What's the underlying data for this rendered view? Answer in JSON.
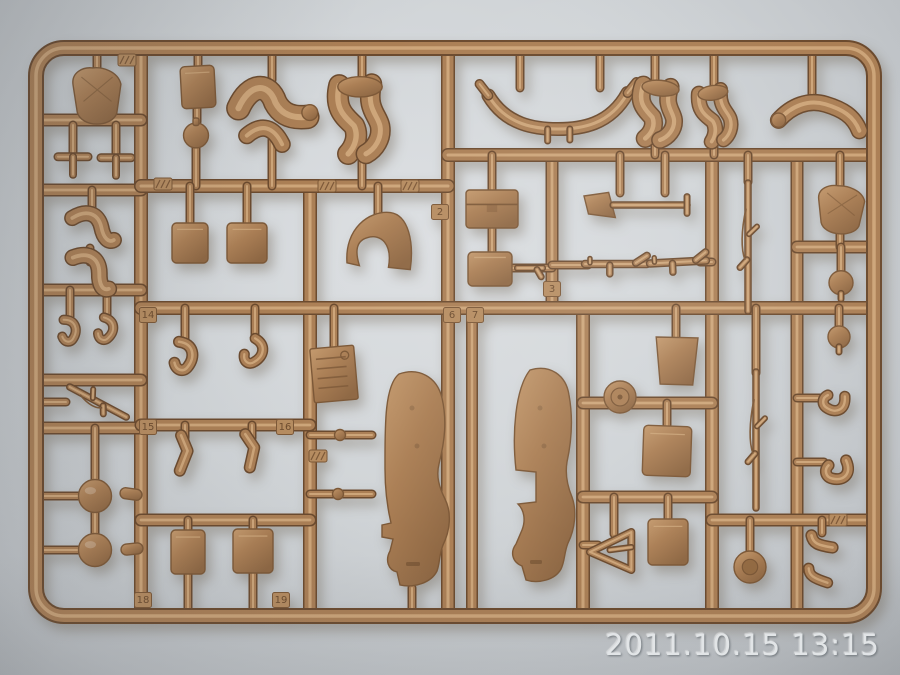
{
  "photo": {
    "timestamp": "2011.10.15 13:15"
  },
  "colors": {
    "background_center": "#dcdfe2",
    "background_mid": "#d0d4d7",
    "background_edge": "#bfc3c7",
    "background_corner": "#aeb2b6",
    "plastic": "#ab7f55",
    "plastic_light": "#c49a6e",
    "plastic_highlight": "#d2ac80",
    "plastic_dark": "#7c5837",
    "plastic_deep": "#6b4a2e",
    "tag_fill": "#b68c60",
    "engraving": "#6d4c2e",
    "timestamp_text": "#e5e8ea",
    "timestamp_shadow": "#747a7f"
  },
  "sprue": {
    "frame": {
      "x": 36,
      "y": 48,
      "w": 838,
      "h": 568,
      "rx": 28,
      "thickness": 12
    },
    "runners": [
      [
        141,
        48,
        141,
        616,
        11
      ],
      [
        310,
        186,
        310,
        616,
        11
      ],
      [
        448,
        48,
        448,
        616,
        11
      ],
      [
        472,
        308,
        472,
        616,
        9
      ],
      [
        552,
        155,
        552,
        308,
        10
      ],
      [
        583,
        308,
        583,
        616,
        11
      ],
      [
        712,
        155,
        712,
        616,
        11
      ],
      [
        797,
        155,
        797,
        616,
        10
      ],
      [
        36,
        120,
        141,
        120,
        10
      ],
      [
        36,
        190,
        141,
        190,
        10
      ],
      [
        36,
        290,
        141,
        290,
        10
      ],
      [
        36,
        380,
        141,
        380,
        10
      ],
      [
        36,
        428,
        141,
        428,
        10
      ],
      [
        141,
        186,
        448,
        186,
        11
      ],
      [
        448,
        155,
        874,
        155,
        11
      ],
      [
        141,
        308,
        874,
        308,
        11
      ],
      [
        141,
        425,
        310,
        425,
        10
      ],
      [
        141,
        520,
        310,
        520,
        10
      ],
      [
        583,
        403,
        712,
        403,
        10
      ],
      [
        583,
        497,
        712,
        497,
        10
      ],
      [
        797,
        247,
        874,
        247,
        10
      ],
      [
        712,
        520,
        874,
        520,
        10
      ]
    ],
    "stubs": [
      [
        97,
        48,
        97,
        72
      ],
      [
        198,
        48,
        198,
        68
      ],
      [
        272,
        48,
        272,
        80
      ],
      [
        362,
        48,
        362,
        82
      ],
      [
        520,
        48,
        520,
        88
      ],
      [
        600,
        48,
        600,
        88
      ],
      [
        655,
        48,
        655,
        84
      ],
      [
        714,
        48,
        714,
        86
      ],
      [
        812,
        48,
        812,
        95
      ],
      [
        272,
        140,
        272,
        186
      ],
      [
        362,
        150,
        362,
        186
      ],
      [
        655,
        136,
        655,
        155
      ],
      [
        714,
        140,
        714,
        155
      ],
      [
        73,
        125,
        73,
        158
      ],
      [
        116,
        125,
        116,
        158
      ],
      [
        92,
        190,
        92,
        210
      ],
      [
        90,
        248,
        90,
        262
      ],
      [
        70,
        290,
        70,
        318
      ],
      [
        107,
        290,
        107,
        318
      ],
      [
        36,
        402,
        66,
        402
      ],
      [
        36,
        496,
        80,
        496
      ],
      [
        36,
        550,
        80,
        550
      ],
      [
        95,
        428,
        95,
        481
      ],
      [
        95,
        512,
        95,
        535
      ],
      [
        197,
        108,
        197,
        122
      ],
      [
        196,
        144,
        196,
        186
      ],
      [
        190,
        186,
        190,
        224
      ],
      [
        247,
        186,
        247,
        224
      ],
      [
        185,
        308,
        185,
        340
      ],
      [
        255,
        308,
        255,
        338
      ],
      [
        185,
        425,
        185,
        438
      ],
      [
        252,
        425,
        252,
        438
      ],
      [
        188,
        520,
        188,
        532
      ],
      [
        253,
        520,
        253,
        531
      ],
      [
        188,
        572,
        188,
        616
      ],
      [
        253,
        572,
        253,
        616
      ],
      [
        378,
        186,
        378,
        216
      ],
      [
        334,
        308,
        334,
        350
      ],
      [
        310,
        435,
        372,
        435
      ],
      [
        310,
        494,
        372,
        494
      ],
      [
        412,
        588,
        412,
        616
      ],
      [
        492,
        155,
        492,
        191
      ],
      [
        492,
        226,
        492,
        252
      ],
      [
        512,
        268,
        552,
        268
      ],
      [
        620,
        155,
        620,
        193
      ],
      [
        665,
        155,
        665,
        193
      ],
      [
        552,
        265,
        588,
        265
      ],
      [
        700,
        262,
        712,
        262
      ],
      [
        748,
        155,
        748,
        182
      ],
      [
        840,
        155,
        840,
        187
      ],
      [
        840,
        232,
        840,
        247
      ],
      [
        841,
        247,
        841,
        273
      ],
      [
        839,
        308,
        839,
        328
      ],
      [
        756,
        308,
        756,
        373
      ],
      [
        797,
        398,
        822,
        398
      ],
      [
        797,
        462,
        824,
        462
      ],
      [
        676,
        308,
        676,
        339
      ],
      [
        667,
        403,
        667,
        427
      ],
      [
        668,
        497,
        668,
        520
      ],
      [
        583,
        545,
        598,
        545
      ],
      [
        614,
        497,
        614,
        534
      ],
      [
        750,
        520,
        750,
        553
      ],
      [
        822,
        520,
        822,
        533
      ]
    ],
    "parts": [
      {
        "n": "torso-figure",
        "t": "torso",
        "x": 97,
        "y": 96,
        "w": 52,
        "h": 54,
        "r": 0
      },
      {
        "n": "pedal-a",
        "t": "tee",
        "x": 73,
        "y": 164,
        "w": 32,
        "h": 24,
        "r": 0
      },
      {
        "n": "pedal-b",
        "t": "tee",
        "x": 116,
        "y": 165,
        "w": 32,
        "h": 24,
        "r": 0
      },
      {
        "n": "bent-arm-a",
        "t": "elbow",
        "x": 92,
        "y": 228,
        "w": 52,
        "h": 40,
        "r": 0
      },
      {
        "n": "bent-arm-b",
        "t": "elbow",
        "x": 90,
        "y": 272,
        "w": 52,
        "h": 42,
        "r": 12
      },
      {
        "n": "hand-a",
        "t": "hook",
        "x": 70,
        "y": 331,
        "w": 24,
        "h": 30,
        "r": -8
      },
      {
        "n": "hand-b",
        "t": "hook",
        "x": 107,
        "y": 330,
        "w": 24,
        "h": 30,
        "r": 8
      },
      {
        "n": "rifle-left",
        "t": "rifle",
        "x": 98,
        "y": 402,
        "w": 0,
        "h": 64,
        "r": -62
      },
      {
        "n": "ball-a",
        "t": "ball",
        "x": 95,
        "y": 496,
        "w": 33,
        "h": 33,
        "r": 0
      },
      {
        "n": "ball-b",
        "t": "ball",
        "x": 95,
        "y": 550,
        "w": 33,
        "h": 33,
        "r": 0
      },
      {
        "n": "capsule-a",
        "t": "capsule",
        "x": 131,
        "y": 494,
        "w": 22,
        "h": 11,
        "r": 8
      },
      {
        "n": "capsule-b",
        "t": "capsule",
        "x": 132,
        "y": 549,
        "w": 22,
        "h": 11,
        "r": -6
      },
      {
        "n": "radio-box",
        "t": "box",
        "x": 198,
        "y": 87,
        "w": 34,
        "h": 42,
        "r": -3
      },
      {
        "n": "canteen",
        "t": "canteen",
        "x": 196,
        "y": 133,
        "w": 26,
        "h": 30,
        "r": 0
      },
      {
        "n": "bending-figure",
        "t": "bentfig",
        "x": 272,
        "y": 114,
        "w": 84,
        "h": 72,
        "r": 0
      },
      {
        "n": "leg-figure-a",
        "t": "legfig",
        "x": 360,
        "y": 118,
        "w": 74,
        "h": 78,
        "r": 0
      },
      {
        "n": "curved-linkage",
        "t": "ubar",
        "x": 558,
        "y": 108,
        "w": 148,
        "h": 50,
        "r": 0
      },
      {
        "n": "leg-figure-b",
        "t": "legfig",
        "x": 658,
        "y": 112,
        "w": 62,
        "h": 60,
        "r": 6
      },
      {
        "n": "leg-figure-c",
        "t": "legfig",
        "x": 716,
        "y": 115,
        "w": 50,
        "h": 56,
        "r": -8
      },
      {
        "n": "arm-right",
        "t": "arm",
        "x": 818,
        "y": 116,
        "w": 94,
        "h": 42,
        "r": 0
      },
      {
        "n": "ammo-box-a",
        "t": "box",
        "x": 190,
        "y": 243,
        "w": 36,
        "h": 40,
        "r": 0
      },
      {
        "n": "ammo-box-b",
        "t": "box",
        "x": 247,
        "y": 243,
        "w": 40,
        "h": 40,
        "r": 0
      },
      {
        "n": "saddle-piece",
        "t": "saddle",
        "x": 378,
        "y": 242,
        "w": 72,
        "h": 62,
        "r": -4
      },
      {
        "n": "lid-box",
        "t": "boxlid",
        "x": 492,
        "y": 209,
        "w": 52,
        "h": 38,
        "r": 0
      },
      {
        "n": "small-box",
        "t": "box",
        "x": 490,
        "y": 269,
        "w": 44,
        "h": 34,
        "r": 0
      },
      {
        "n": "pistol",
        "t": "pistol",
        "x": 530,
        "y": 268,
        "w": 28,
        "h": 16,
        "r": 0
      },
      {
        "n": "shovel",
        "t": "shovel",
        "x": 640,
        "y": 205,
        "w": 112,
        "h": 30,
        "r": 0
      },
      {
        "n": "machine-gun-a",
        "t": "mg",
        "x": 616,
        "y": 264,
        "w": 62,
        "h": 22,
        "r": 0
      },
      {
        "n": "machine-gun-b",
        "t": "mg",
        "x": 678,
        "y": 262,
        "w": 56,
        "h": 22,
        "r": -3
      },
      {
        "n": "rifle-a",
        "t": "rifle",
        "x": 748,
        "y": 247,
        "w": 0,
        "h": 128,
        "r": 0
      },
      {
        "n": "torso-right",
        "t": "torso",
        "x": 841,
        "y": 210,
        "w": 50,
        "h": 46,
        "r": 4
      },
      {
        "n": "head-a",
        "t": "head",
        "x": 841,
        "y": 285,
        "w": 24,
        "h": 28,
        "r": 0
      },
      {
        "n": "head-b",
        "t": "head",
        "x": 839,
        "y": 339,
        "w": 22,
        "h": 26,
        "r": 0
      },
      {
        "n": "license-plate",
        "t": "plate",
        "x": 334,
        "y": 374,
        "w": 44,
        "h": 54,
        "r": -5
      },
      {
        "n": "fender-left",
        "t": "fenderL",
        "x": 412,
        "y": 478,
        "w": 88,
        "h": 216,
        "r": 0
      },
      {
        "n": "fender-right",
        "t": "fenderR",
        "x": 538,
        "y": 474,
        "w": 80,
        "h": 210,
        "r": 0
      },
      {
        "n": "holster-a",
        "t": "hook",
        "x": 185,
        "y": 357,
        "w": 30,
        "h": 38,
        "r": 0
      },
      {
        "n": "holster-b",
        "t": "hook",
        "x": 255,
        "y": 353,
        "w": 27,
        "h": 34,
        "r": 22
      },
      {
        "n": "small-figure-a",
        "t": "smallfig",
        "x": 185,
        "y": 453,
        "w": 26,
        "h": 42,
        "r": 0
      },
      {
        "n": "small-figure-b",
        "t": "smallfig",
        "x": 252,
        "y": 450,
        "w": 26,
        "h": 40,
        "r": -10
      },
      {
        "n": "crate-a",
        "t": "box",
        "x": 188,
        "y": 552,
        "w": 34,
        "h": 44,
        "r": 0
      },
      {
        "n": "crate-b",
        "t": "box",
        "x": 253,
        "y": 551,
        "w": 40,
        "h": 44,
        "r": 0
      },
      {
        "n": "trapezoid-box",
        "t": "trapbox",
        "x": 676,
        "y": 361,
        "w": 44,
        "h": 48,
        "r": 0
      },
      {
        "n": "headlight",
        "t": "headlight",
        "x": 620,
        "y": 397,
        "w": 32,
        "h": 32,
        "r": 0
      },
      {
        "n": "storage-box",
        "t": "box",
        "x": 667,
        "y": 451,
        "w": 48,
        "h": 50,
        "r": 2
      },
      {
        "n": "a-frame",
        "t": "tri",
        "x": 612,
        "y": 552,
        "w": 46,
        "h": 40,
        "r": 0
      },
      {
        "n": "box-lower",
        "t": "box",
        "x": 668,
        "y": 542,
        "w": 40,
        "h": 46,
        "r": 0
      },
      {
        "n": "rifle-b",
        "t": "rifle",
        "x": 756,
        "y": 440,
        "w": 0,
        "h": 136,
        "r": 0
      },
      {
        "n": "pouch-a",
        "t": "hook",
        "x": 834,
        "y": 404,
        "w": 28,
        "h": 30,
        "r": 80
      },
      {
        "n": "pouch-b",
        "t": "hook",
        "x": 838,
        "y": 472,
        "w": 30,
        "h": 32,
        "r": 60
      },
      {
        "n": "road-wheel",
        "t": "wheel",
        "x": 750,
        "y": 567,
        "w": 32,
        "h": 32,
        "r": 0
      },
      {
        "n": "boot-a",
        "t": "boot",
        "x": 822,
        "y": 542,
        "w": 30,
        "h": 22,
        "r": 0
      },
      {
        "n": "boot-b",
        "t": "boot",
        "x": 818,
        "y": 576,
        "w": 30,
        "h": 20,
        "r": 10
      },
      {
        "n": "stub-nub-a",
        "t": "nub",
        "x": 340,
        "y": 435,
        "w": 11,
        "h": 11,
        "r": 0
      },
      {
        "n": "stub-nub-b",
        "t": "nub",
        "x": 338,
        "y": 494,
        "w": 11,
        "h": 11,
        "r": 0
      }
    ],
    "tags": [
      {
        "label": "2",
        "x": 440,
        "y": 212
      },
      {
        "label": "6",
        "x": 452,
        "y": 315
      },
      {
        "label": "7",
        "x": 475,
        "y": 315
      },
      {
        "label": "3",
        "x": 552,
        "y": 289
      },
      {
        "label": "14",
        "x": 148,
        "y": 315
      },
      {
        "label": "15",
        "x": 148,
        "y": 427
      },
      {
        "label": "16",
        "x": 285,
        "y": 427
      },
      {
        "label": "18",
        "x": 143,
        "y": 600
      },
      {
        "label": "19",
        "x": 281,
        "y": 600
      }
    ],
    "hatch_tabs": [
      {
        "x": 127,
        "y": 60
      },
      {
        "x": 163,
        "y": 184
      },
      {
        "x": 327,
        "y": 186
      },
      {
        "x": 410,
        "y": 186
      },
      {
        "x": 318,
        "y": 456
      },
      {
        "x": 838,
        "y": 520
      }
    ]
  }
}
